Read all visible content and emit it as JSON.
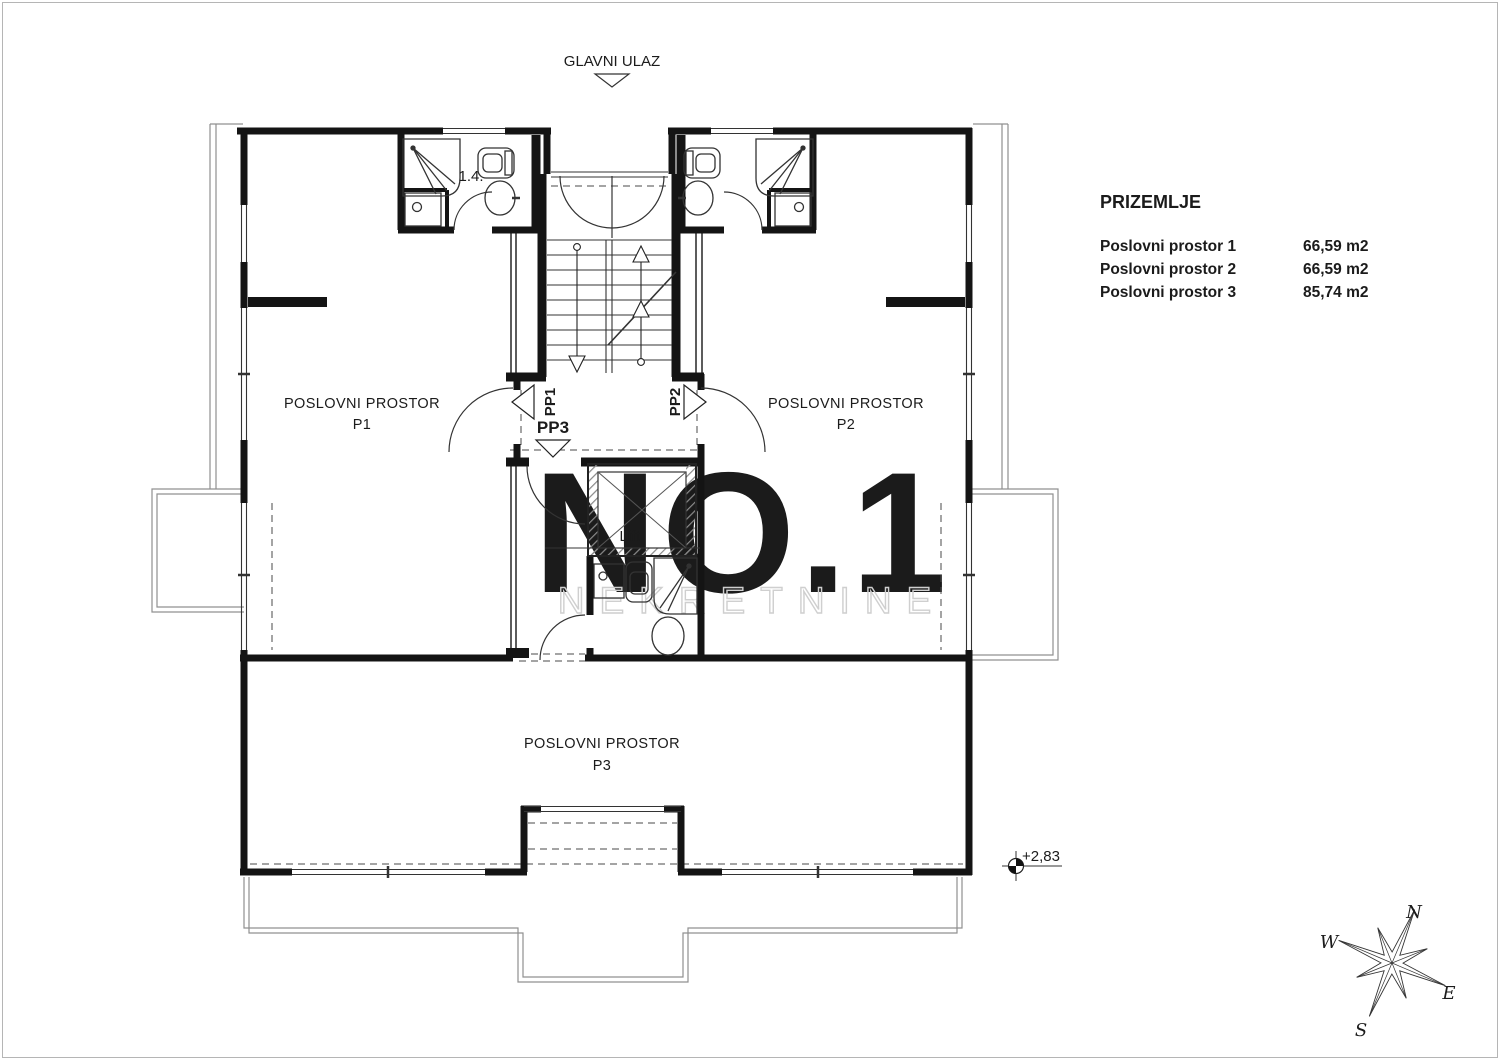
{
  "entrance": {
    "label": "GLAVNI ULAZ"
  },
  "legend": {
    "title": "PRIZEMLJE",
    "rows": [
      {
        "label": "Poslovni prostor 1",
        "area": "66,59 m2"
      },
      {
        "label": "Poslovni prostor 2",
        "area": "66,59 m2"
      },
      {
        "label": "Poslovni prostor 3",
        "area": "85,74 m2"
      }
    ]
  },
  "rooms": {
    "p1": {
      "line1": "POSLOVNI PROSTOR",
      "line2": "P1"
    },
    "p2": {
      "line1": "POSLOVNI PROSTOR",
      "line2": "P2"
    },
    "p3": {
      "line1": "POSLOVNI PROSTOR",
      "line2": "P3"
    }
  },
  "doors": {
    "pp1": "PP1",
    "pp2": "PP2",
    "pp3": "PP3"
  },
  "labels": {
    "bathroom": "1.4.",
    "lift": "Lift",
    "elevation": "+2,83"
  },
  "compass": {
    "n": "N",
    "e": "E",
    "s": "S",
    "w": "W"
  },
  "watermark": {
    "line1": "NO.1",
    "line2": "NEKRETNINE"
  },
  "colors": {
    "wall": "#141414",
    "thin_line": "#333333",
    "terrace": "#909090",
    "watermark": "#dadada"
  }
}
